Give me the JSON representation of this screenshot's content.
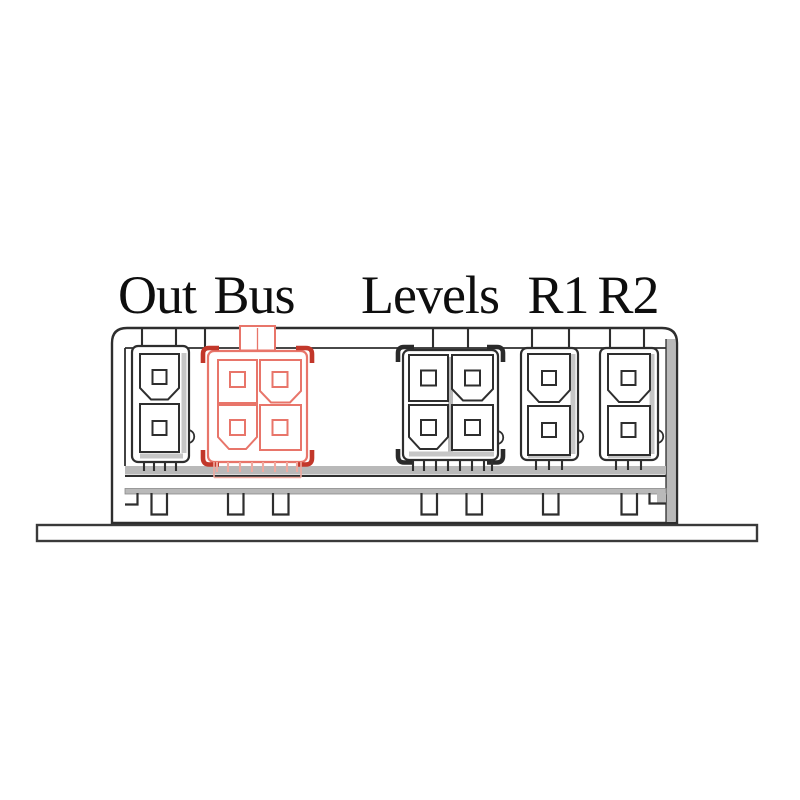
{
  "labels": {
    "out": "Out",
    "bus": "Bus",
    "levels": "Levels",
    "r1": "R1",
    "r2": "R2"
  },
  "connectors": [
    {
      "label": "Out",
      "pins": 2,
      "highlighted": false
    },
    {
      "label": "Bus",
      "pins": 4,
      "highlighted": true
    },
    {
      "label": "Levels",
      "pins": 4,
      "highlighted": false
    },
    {
      "label": "R1",
      "pins": 2,
      "highlighted": false
    },
    {
      "label": "R2",
      "pins": 2,
      "highlighted": false
    }
  ],
  "colors": {
    "line": "#2e2e2e",
    "shadow_gray": "#b9b9b9",
    "highlight_red": "#e8756a",
    "highlight_dark_red": "#c2372a",
    "background": "#ffffff"
  }
}
